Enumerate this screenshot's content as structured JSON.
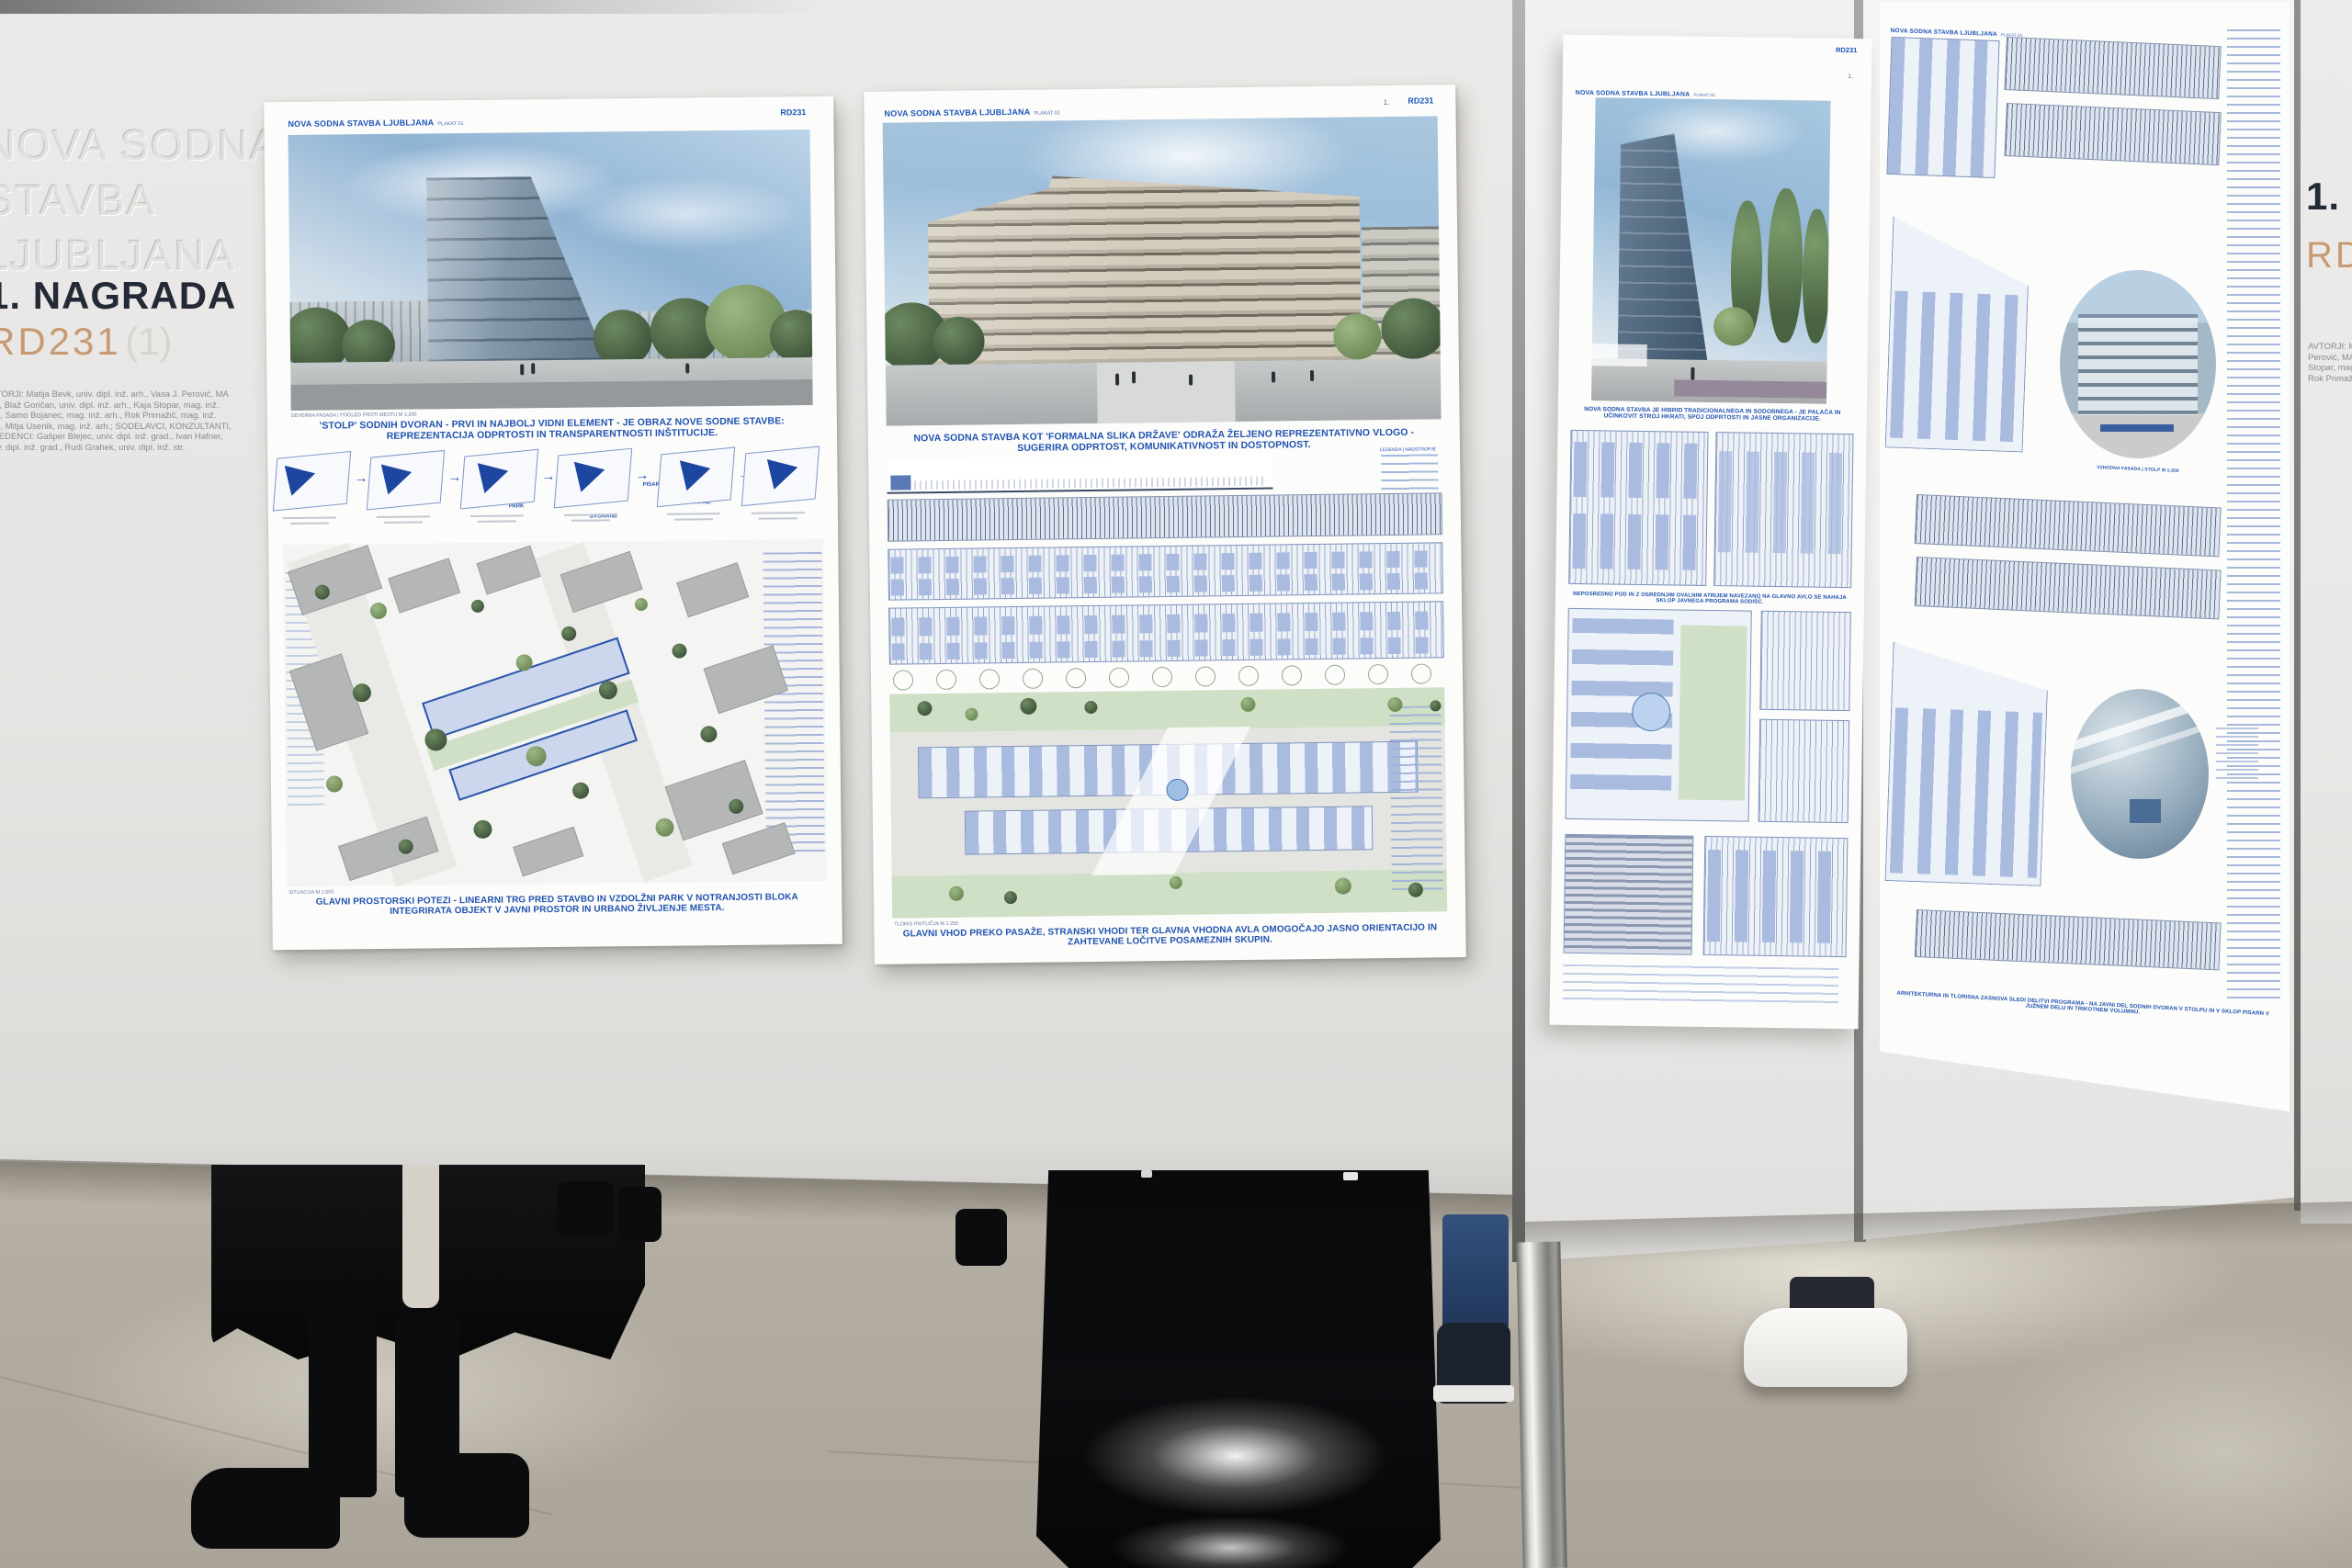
{
  "wall_left": {
    "title_line1": "NOVA SODNA",
    "title_line2": "STAVBA",
    "title_line3": "LJUBLJANA",
    "award": "1. NAGRADA",
    "code": "RD231",
    "code_suffix": "(1)",
    "credits": "AVTORJI: Matija Bevk, univ. dipl. inž. arh., Vasa J. Perović, MA BIA, Blaž Goričan, univ. dipl. inž. arh., Kaja Stopar, mag. inž. arh., Samo Bojanec, mag. inž. arh., Rok Primažič, mag. inž. arh., Mitja Usenik, mag. inž. arh.; SODELAVCI, KONZULTANTI, IZVEDENCI: Gašper Blejec, univ. dipl. inž. grad., Ivan Hafner, univ. dipl. inž. grad., Rudi Grahek, univ. dipl. inž. str."
  },
  "wall_right": {
    "award": "1. NAGRADA",
    "code": "RD231",
    "credits": "AVTORJI: Matija Bevk, univ. dipl. inž. arh., Vasa J. Perović, MA BIA, Blaž Goričan, univ. dipl. inž. arh., Kaja Stopar, mag. inž. arh., Samo Bojanec, mag. inž. arh., Rok Primažič, mag. inž. arh., Mitja Usenik, mag. inž. arh."
  },
  "panel1": {
    "title": "NOVA SODNA STAVBA LJUBLJANA",
    "subtitle": "PLAKAT 01",
    "code": "RD231",
    "number": "1.",
    "image_label": "SEVERNA FASADA | POGLED PROTI MESTU M 1:200",
    "caption1": "'STOLP' SODNIH DVORAN - PRVI IN NAJBOLJ VIDNI ELEMENT - JE OBRAZ NOVE SODNE STAVBE: REPREZENTACIJA ODPRTOSTI IN TRANSPARENTNOSTI INŠTITUCIJE.",
    "diagram_labels": [
      "PARK",
      "DVORANE",
      "PISARNE",
      "DVORANE"
    ],
    "site_label": "SITUACIJA M 1:500",
    "caption2": "GLAVNI PROSTORSKI POTEZI - LINEARNI TRG PRED STAVBO IN VZDOLŽNI PARK V NOTRANJOSTI BLOKA INTEGRIRATA OBJEKT V JAVNI PROSTOR IN URBANO ŽIVLJENJE MESTA."
  },
  "panel2": {
    "title": "NOVA SODNA STAVBA LJUBLJANA",
    "subtitle": "PLAKAT 02",
    "code": "RD231",
    "number": "1.",
    "caption1": "NOVA SODNA STAVBA KOT 'FORMALNA SLIKA DRŽAVE' ODRAŽA ŽELJENO REPREZENTATIVNO VLOGO - SUGERIRA ODPRTOST, KOMUNIKATIVNOST IN DOSTOPNOST.",
    "plan_label": "TLORIS PRITLIČJA M 1:250",
    "legend_label": "LEGENDA | NADSTROPJE",
    "caption2": "GLAVNI VHOD PREKO PASAŽE, STRANSKI VHODI TER GLAVNA VHODNA AVLA OMOGOČAJO JASNO ORIENTACIJO IN ZAHTEVANE LOČITVE POSAMEZNIH SKUPIN."
  },
  "panel3": {
    "title": "NOVA SODNA STAVBA LJUBLJANA",
    "subtitle": "PLAKAT 03",
    "code": "RD231",
    "number": "1.",
    "caption1": "NOVA SODNA STAVBA JE HIBRID TRADICIONALNEGA IN SODOBNEGA - JE PALAČA IN UČINKOVIT STROJ HKRATI, SPOJ ODPRTOSTI IN JASNE ORGANIZACIJE.",
    "caption2": "NEPOSREDNO POD IN Z OSREDNJIM OVALNIM ATRIJEM NAVEZANO NA GLAVNO AVLO SE NAHAJA SKLOP JAVNEGA PROGRAMA SODIŠČ."
  },
  "panel4": {
    "title": "NOVA SODNA STAVBA LJUBLJANA",
    "subtitle": "PLAKAT 04",
    "circle_label": "VZHODNA FASADA | STOLP M 1:200",
    "caption": "ARHITEKTURNA IN TLORISNA ZASNOVA SLEDI DELITVI PROGRAMA - NA JAVNI DEL SODNIH DVORAN V STOLPU IN V SKLOP PISARN V JUŽNEM DELU IN TRIKOTNEM VOLUMNU."
  },
  "colors": {
    "accent_blue": "#2153b0",
    "award_dark": "#232a35",
    "code_tan": "#c79a72",
    "wall": "#e6e5e3",
    "floor": "#b5afa4"
  }
}
